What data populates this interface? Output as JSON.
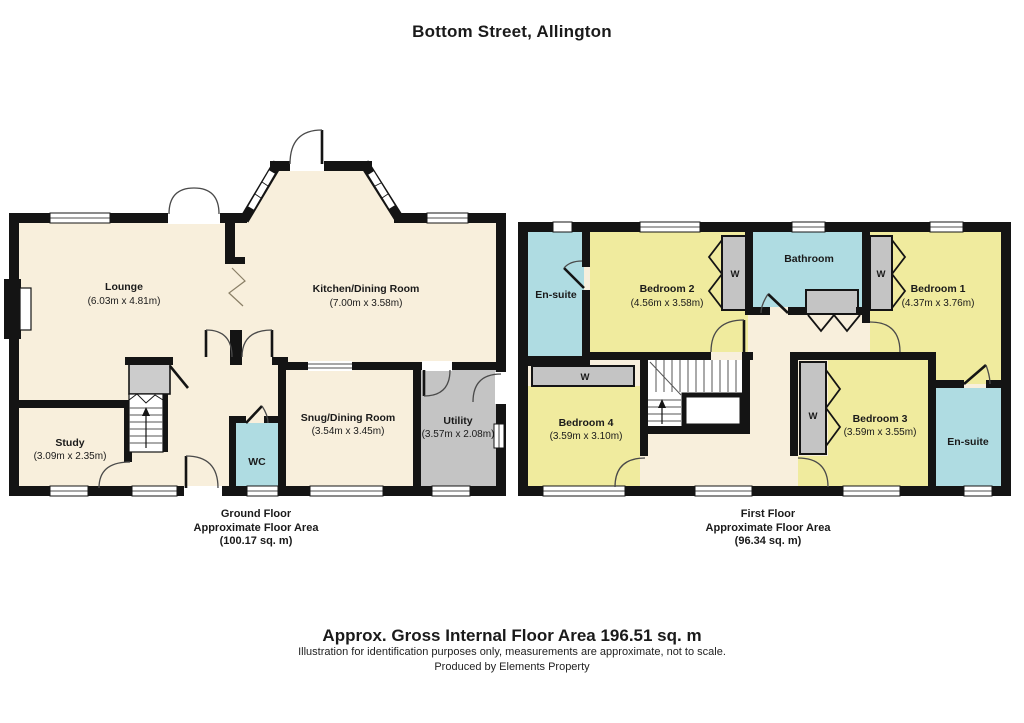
{
  "title": "Bottom Street, Allington",
  "wardrobe": "W",
  "colors": {
    "room_cream": "#F8EFDC",
    "bedroom_yellow": "#F0EB9E",
    "bathroom_cyan": "#AFDCE2",
    "storage_grey": "#C4C4C4",
    "wall_black": "#141414"
  },
  "gf": {
    "caption": {
      "l1": "Ground Floor",
      "l2": "Approximate Floor Area",
      "l3": "(100.17 sq. m)"
    },
    "lounge": {
      "name": "Lounge",
      "dims": "(6.03m x 4.81m)"
    },
    "kitchen": {
      "name": "Kitchen/Dining Room",
      "dims": "(7.00m x 3.58m)"
    },
    "study": {
      "name": "Study",
      "dims": "(3.09m x 2.35m)"
    },
    "snug": {
      "name": "Snug/Dining Room",
      "dims": "(3.54m x 3.45m)"
    },
    "utility": {
      "name": "Utility",
      "dims": "(3.57m x 2.08m)"
    },
    "wc": {
      "name": "WC"
    }
  },
  "ff": {
    "caption": {
      "l1": "First Floor",
      "l2": "Approximate Floor Area",
      "l3": "(96.34 sq. m)"
    },
    "ensuite_top": {
      "name": "En-suite"
    },
    "bedroom2": {
      "name": "Bedroom 2",
      "dims": "(4.56m x 3.58m)"
    },
    "bathroom": {
      "name": "Bathroom"
    },
    "bedroom1": {
      "name": "Bedroom 1",
      "dims": "(4.37m x 3.76m)"
    },
    "bedroom4": {
      "name": "Bedroom 4",
      "dims": "(3.59m x 3.10m)"
    },
    "bedroom3": {
      "name": "Bedroom 3",
      "dims": "(3.59m x 3.55m)"
    },
    "ensuite_bottom": {
      "name": "En-suite"
    }
  },
  "footer": {
    "total": "Approx. Gross Internal Floor Area 196.51 sq. m",
    "disclaimer": "Illustration for identification purposes only, measurements are approximate, not to scale.",
    "produced_by": "Produced by Elements Property"
  }
}
